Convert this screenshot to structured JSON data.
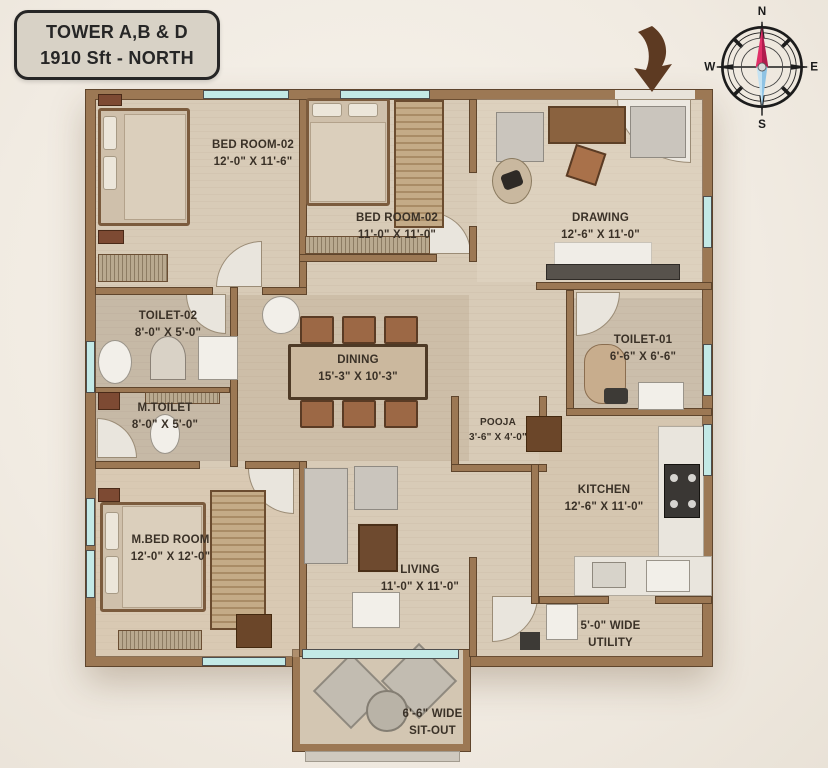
{
  "title": {
    "line1": "TOWER A,B & D",
    "line2": "1910 Sft - NORTH"
  },
  "compass": {
    "north": "N",
    "east": "E",
    "south": "S",
    "west": "W"
  },
  "rooms": {
    "bedroom2_left": {
      "name": "BED ROOM-02",
      "dims": "12'-0\" X 11'-6\""
    },
    "bedroom2_mid": {
      "name": "BED ROOM-02",
      "dims": "11'-0\" X 11'-0\""
    },
    "drawing": {
      "name": "DRAWING",
      "dims": "12'-6\" X 11'-0\""
    },
    "toilet2": {
      "name": "TOILET-02",
      "dims": "8'-0\" X 5'-0\""
    },
    "mtoilet": {
      "name": "M.TOILET",
      "dims": "8'-0\" X 5'-0\""
    },
    "dining": {
      "name": "DINING",
      "dims": "15'-3\" X 10'-3\""
    },
    "toilet1": {
      "name": "TOILET-01",
      "dims": "6'-6\" X 6'-6\""
    },
    "pooja": {
      "name": "POOJA",
      "dims": "3'-6\" X 4'-0\""
    },
    "kitchen": {
      "name": "KITCHEN",
      "dims": "12'-6\" X 11'-0\""
    },
    "master_bedroom": {
      "name": "M.BED ROOM",
      "dims": "12'-0\" X 12'-0\""
    },
    "living": {
      "name": "LIVING",
      "dims": "11'-0\" X 11'-0\""
    },
    "utility": {
      "name": "UTILITY",
      "dims": "5'-0\" WIDE"
    },
    "sitout": {
      "name": "SIT-OUT",
      "dims": "6'-6\" WIDE"
    }
  },
  "colors": {
    "wall": "#9c7854",
    "floor": "#d8cbb7",
    "window": "#c3e9e6",
    "needle_north": "#d0245e",
    "needle_south": "#aed6ec",
    "entry_arrow": "#5d3a22"
  }
}
